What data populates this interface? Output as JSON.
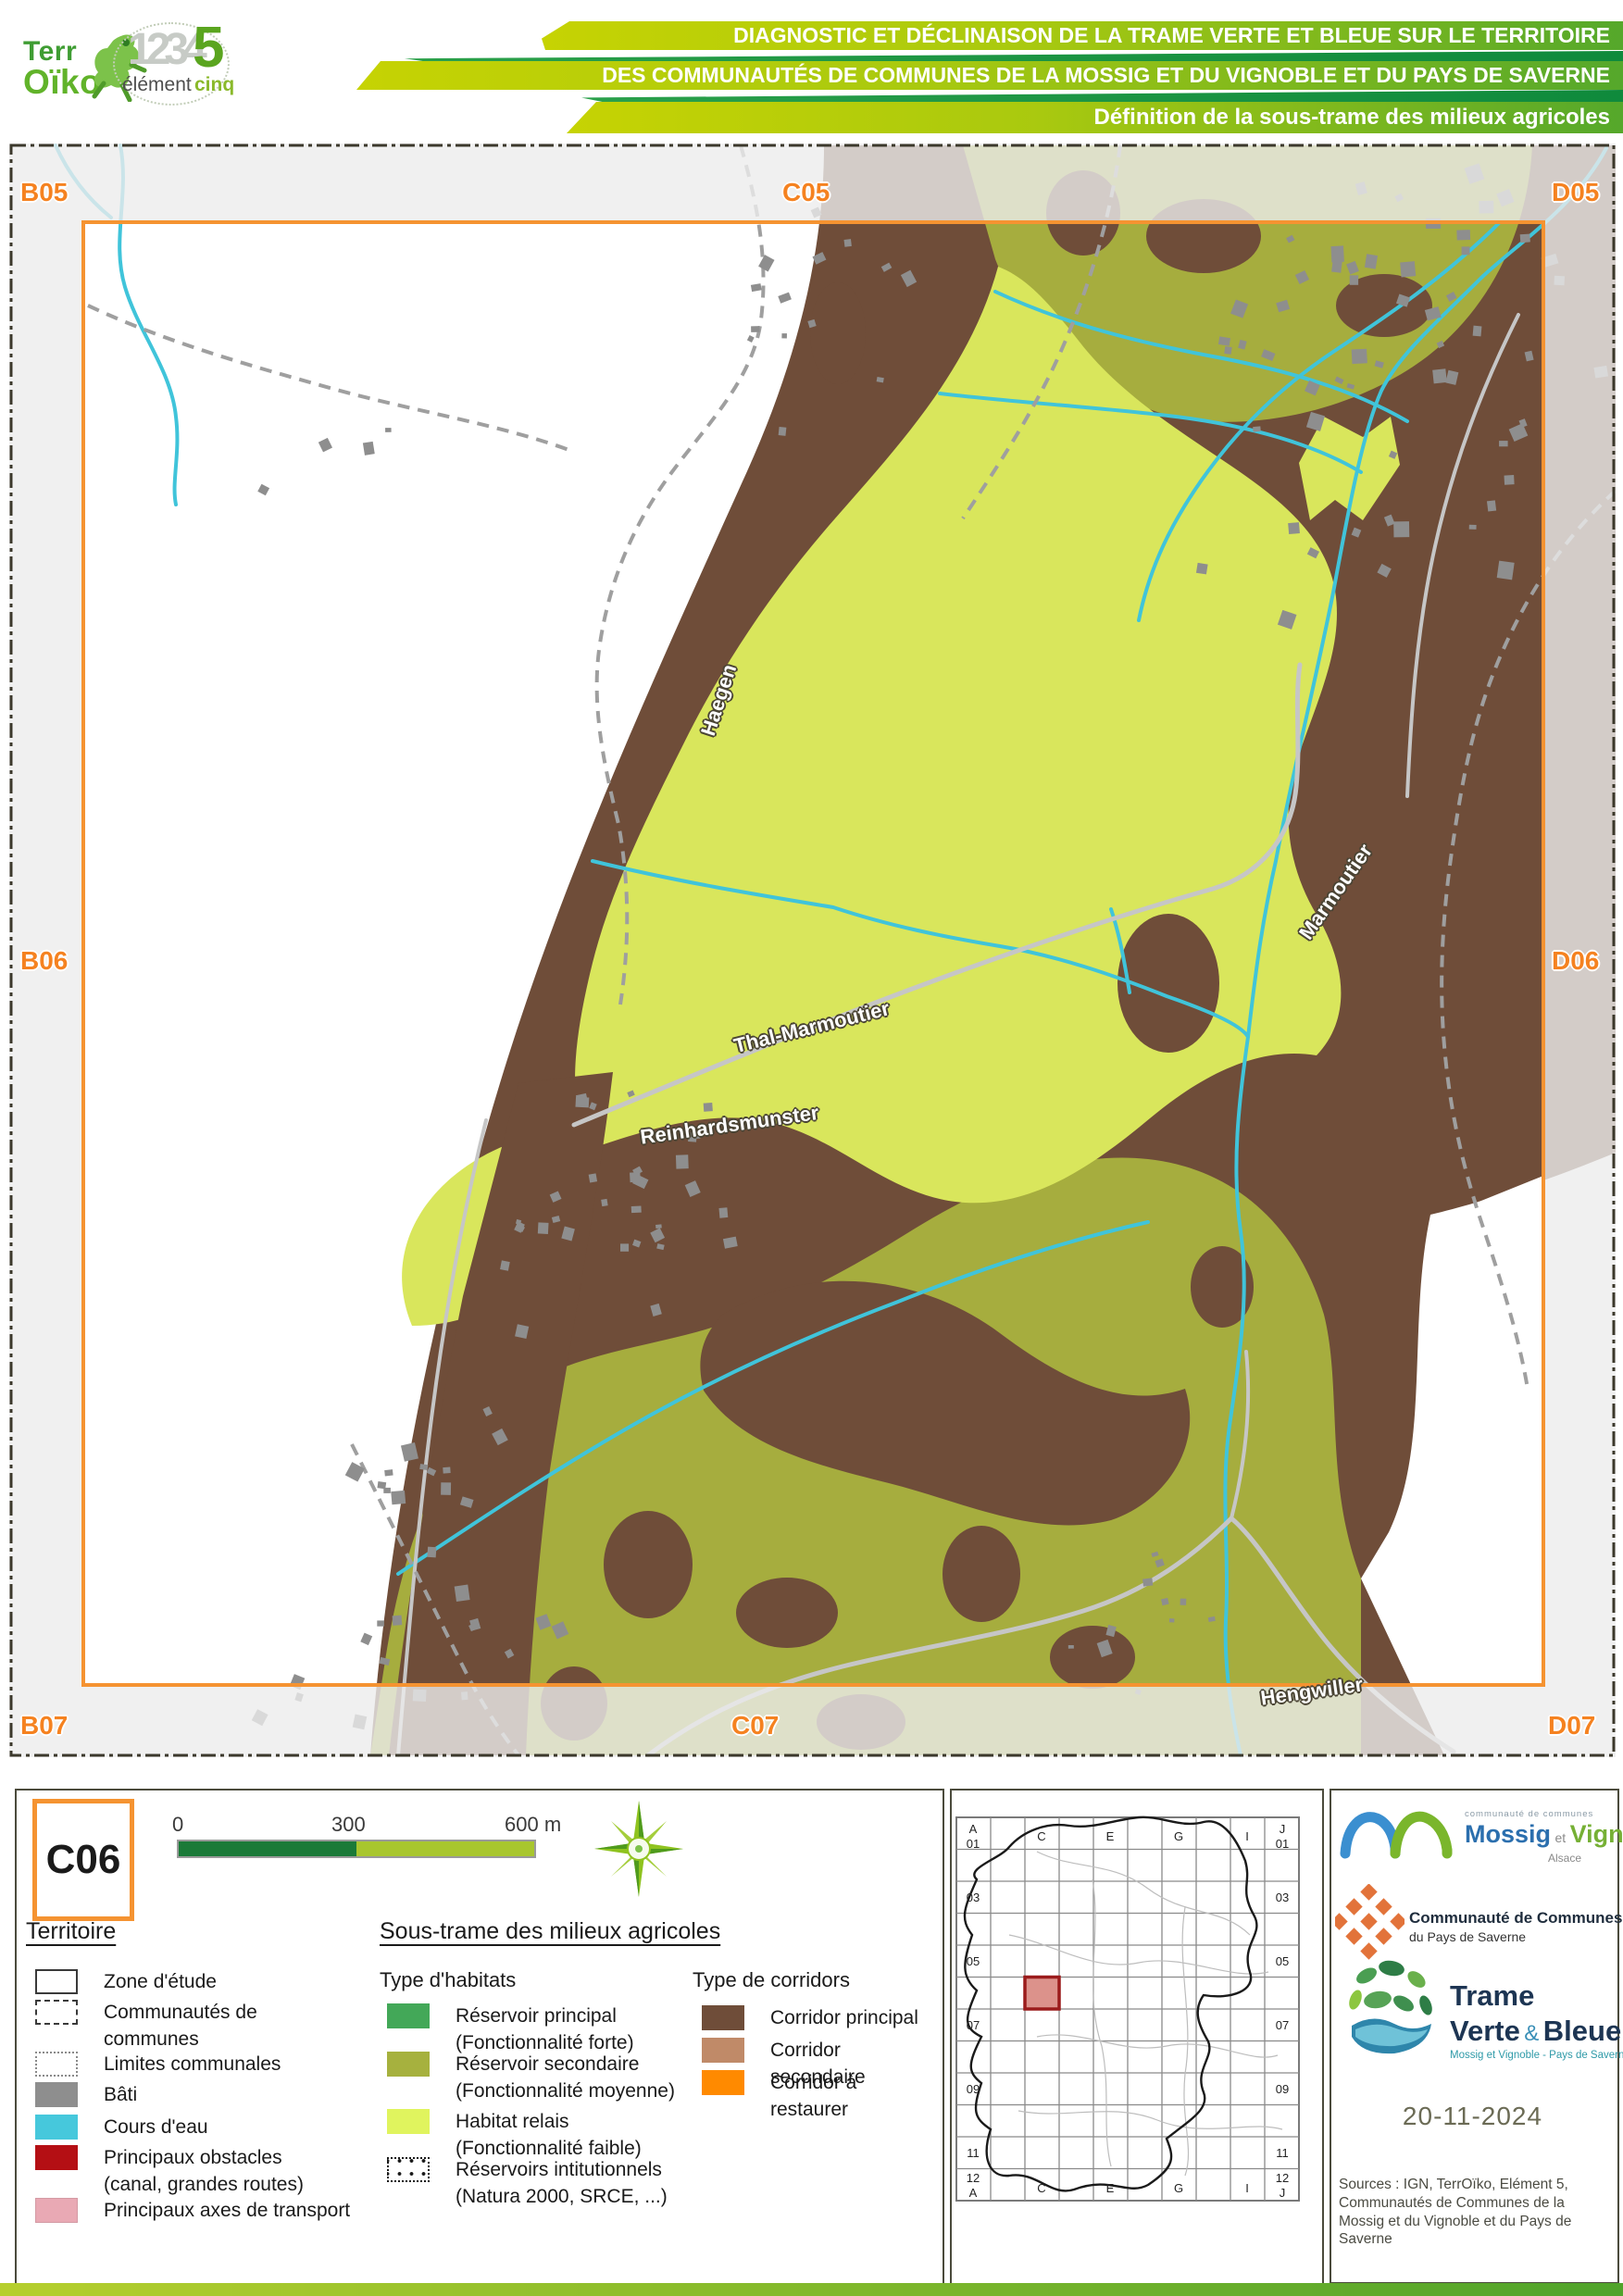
{
  "header": {
    "terroiko": {
      "line1": "Terr",
      "line2": "Oïko"
    },
    "elementcinq": {
      "digits": "1234",
      "five": "5",
      "word1": "élément",
      "word2": "cinq"
    },
    "banners": [
      "DIAGNOSTIC ET DÉCLINAISON DE LA TRAME VERTE ET BLEUE SUR LE TERRITOIRE",
      "DES COMMUNAUTÉS DE COMMUNES DE LA MOSSIG ET DU VIGNOBLE ET DU PAYS DE SAVERNE",
      "Définition de la sous-trame des milieux agricoles"
    ]
  },
  "map": {
    "grid_labels": [
      {
        "label": "B05"
      },
      {
        "label": "C05"
      },
      {
        "label": "D05"
      },
      {
        "label": "B06"
      },
      {
        "label": "D06"
      },
      {
        "label": "B07"
      },
      {
        "label": "C07"
      },
      {
        "label": "D07"
      }
    ],
    "places": [
      {
        "name": "Haegen"
      },
      {
        "name": "Marmoutier"
      },
      {
        "name": "Thal-Marmoutier"
      },
      {
        "name": "Reinhardsmunster"
      },
      {
        "name": "Hengwiller"
      }
    ],
    "colors": {
      "corridor_principal": "#6F4D39",
      "reservoir_secondaire": "#A6AD3E",
      "habitat_relais": "#D9E65C",
      "cours_eau": "#40C4DA",
      "bati": "#8E8E8E",
      "frame_orange": "#F59331",
      "road": "#C6C6C6",
      "limite": "#9F9F9F"
    }
  },
  "legend": {
    "tile": "C06",
    "scale": {
      "t0": "0",
      "t300": "300",
      "t600": "600 m"
    },
    "territoire": {
      "title": "Territoire",
      "items": [
        {
          "label": "Zone d'étude",
          "sub": "",
          "style": "background:#ffffff;border:2px solid #3a3a3a"
        },
        {
          "label": "Communautés de communes",
          "sub": "",
          "style": "background:#ffffff;border:2px dashed #3a3a3a"
        },
        {
          "label": "Limites communales",
          "sub": "",
          "style": "background:#ffffff;border:2px dotted #8a8a8a"
        },
        {
          "label": "Bâti",
          "sub": "",
          "style": "background:#8E8E8E"
        },
        {
          "label": "Cours d'eau",
          "sub": "",
          "style": "background:#46C8DC"
        },
        {
          "label": "Principaux obstacles",
          "sub": "(canal, grandes routes)",
          "style": "background:#B40F14"
        },
        {
          "label": "Principaux axes de transport",
          "sub": "",
          "style": "background:#E9A9B4;border:1px solid #d49aa4"
        }
      ]
    },
    "soustrame": {
      "title": "Sous-trame des milieux agricoles",
      "habitats_title": "Type d'habitats",
      "corridors_title": "Type de corridors",
      "habitats": [
        {
          "label": "Réservoir principal",
          "sub": "(Fonctionnalité forte)",
          "style": "background:#43A858"
        },
        {
          "label": "Réservoir secondaire",
          "sub": "(Fonctionnalité moyenne)",
          "style": "background:#A6B13E"
        },
        {
          "label": "Habitat relais",
          "sub": "(Fonctionnalité faible)",
          "style": "background:#E0F45E"
        },
        {
          "label": "Réservoirs intitutionnels",
          "sub": "(Natura 2000, SRCE, ...)",
          "style": "background:#ffffff;border:2px dotted #1a1a1a;background-image:radial-gradient(circle,#1a1a1a 1.7px,transparent 2.2px);background-size:13px 14px;background-position:5px 9px"
        }
      ],
      "corridors": [
        {
          "label": "Corridor principal",
          "style": "background:#6F4D39"
        },
        {
          "label": "Corridor secondaire",
          "style": "background:#C08A68"
        },
        {
          "label": "Corridor à restaurer",
          "style": "background:#FF8A00"
        }
      ]
    }
  },
  "inset": {
    "tl1": "A",
    "tl2": "01",
    "tr1": "J",
    "tr2": "01",
    "top": [
      "C",
      "E",
      "G",
      "I"
    ],
    "rows": [
      "03",
      "05",
      "07",
      "09",
      "11"
    ],
    "bl1": "12",
    "bl2": "A",
    "br1": "12",
    "br2": "J",
    "bottom": [
      "C",
      "E",
      "G",
      "I"
    ]
  },
  "right_panel": {
    "mossig": {
      "small": "communauté de communes",
      "name1": "Mossig",
      "et": "et",
      "name2": "Vignoble",
      "region": "Alsace"
    },
    "saverne": {
      "line1": "Communauté de Communes",
      "line2": "du Pays de Saverne"
    },
    "tvb": {
      "line1": "Trame",
      "line2a": "Verte",
      "amp": "&",
      "line2b": "Bleue",
      "sub": "Mossig et Vignoble - Pays de Saverne"
    },
    "date": "20-11-2024",
    "sources": "Sources : IGN, TerrOïko, Elément 5, Communautés de Communes de la Mossig et du Vignoble et du Pays de Saverne"
  }
}
